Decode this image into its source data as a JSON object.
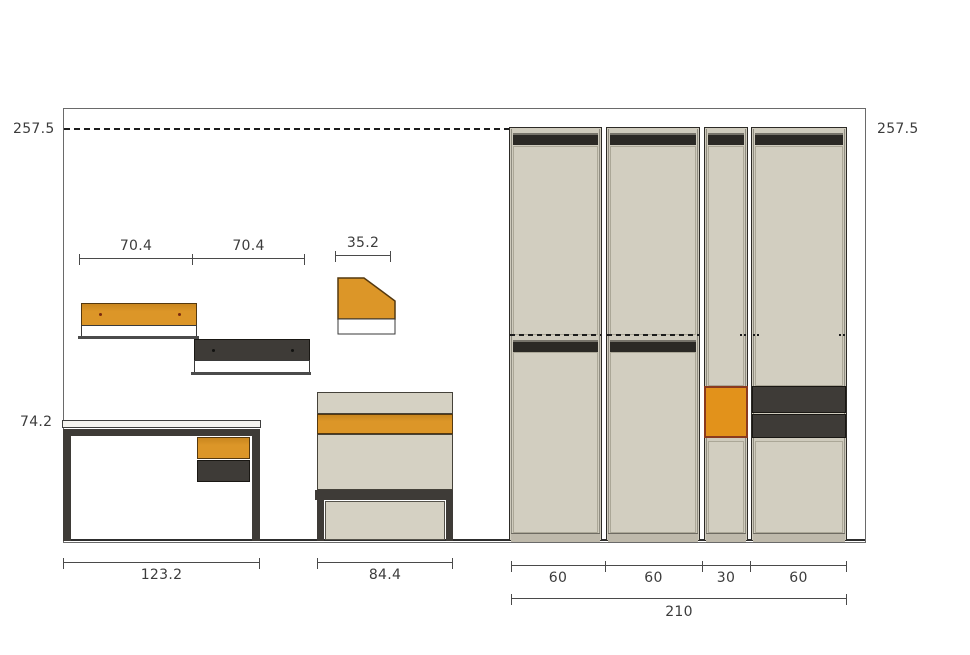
{
  "labels": {
    "wall_height_left": "257.5",
    "wall_height_right": "257.5",
    "shelf_span_left": "70.4",
    "shelf_span_right": "70.4",
    "corner_shelf_width": "35.2",
    "desk_height": "74.2",
    "desk_width": "123.2",
    "dresser_width": "84.4",
    "wardrobe_sections": [
      "60",
      "60",
      "30",
      "60"
    ],
    "wardrobe_total_width": "210"
  },
  "colors": {
    "accent_orange": "#dc9628",
    "wardrobe_box_orange": "#e2921b",
    "wardrobe_box_border": "#8b3a1e",
    "dark_gray": "#3e3b37",
    "panel_beige": "#cfcbbd",
    "line": "#4a4a4a"
  }
}
